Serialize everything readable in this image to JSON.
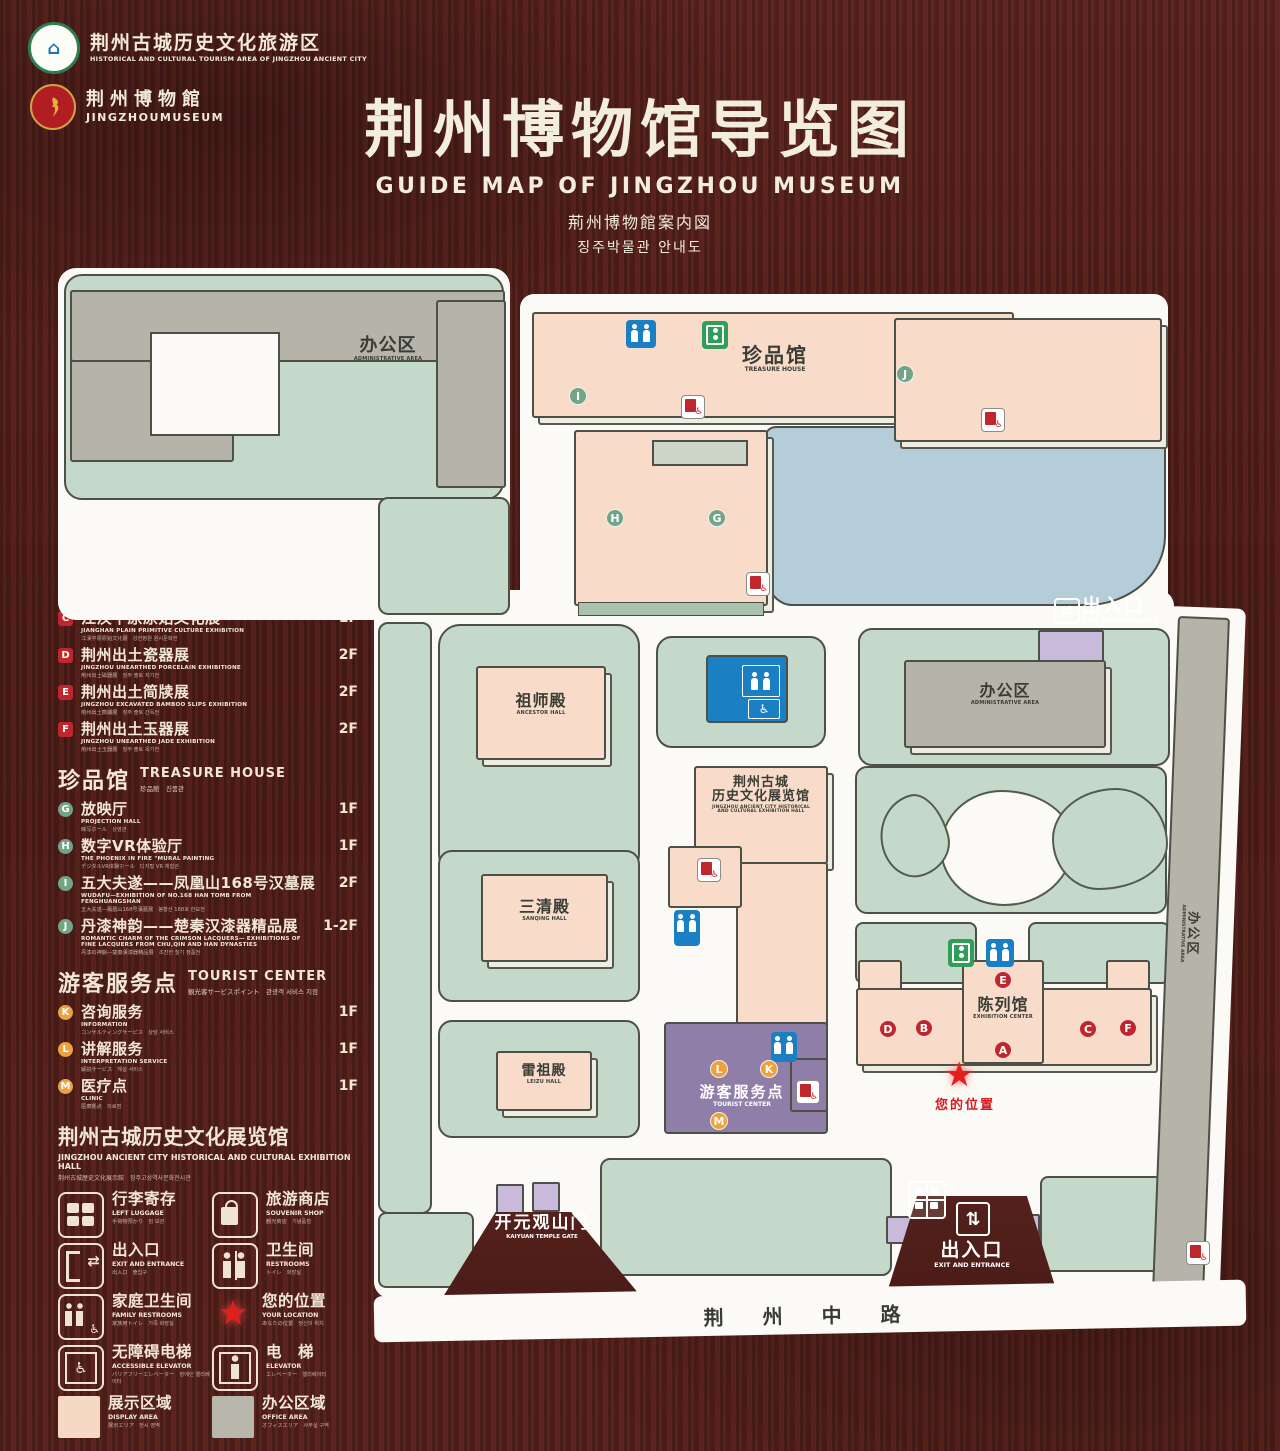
{
  "header": {
    "logo1": {
      "zh": "荆州古城历史文化旅游区",
      "en": "HISTORICAL AND CULTURAL TOURISM AREA OF JINGZHOU ANCIENT CITY"
    },
    "logo2": {
      "zh": "荆州博物館",
      "en": "JINGZHOUMUSEUM"
    },
    "title": "荆州博物馆导览图",
    "subtitle_en": "GUIDE MAP OF JINGZHOU MUSEUM",
    "subtitle_ja": "荊州博物館案内図",
    "subtitle_ko": "징주박물관 안내도"
  },
  "legend": {
    "exhibition": {
      "title_zh": "陈列馆",
      "title_en": "EXHIBITION CENTER",
      "title_sub": "陳列館　진열관",
      "items": [
        {
          "letter": "A",
          "zh": "《火中的凤凰》壁画",
          "en": "THE PHOENIX IN FIRE \"MURAL PAINTING",
          "sub": "「火中の鳳凰」壁画　《불 속의 봉황》 벽화",
          "floor": "1F"
        },
        {
          "letter": "B",
          "zh": "荆州出土铜器展",
          "en": "JINGZHOU UNEARTHED BRONZE WARE EXHIBITION",
          "sub": "荊州出土銅器展　징주 출토 동기 전시",
          "floor": "1F"
        },
        {
          "letter": "C",
          "zh": "江汉平原原始文化展",
          "en": "JIANGHAN PLAIN PRIMITIVE CULTURE EXHIBITION",
          "sub": "江漢平原原始文化展　강한평원 원시문화전",
          "floor": "1F"
        },
        {
          "letter": "D",
          "zh": "荆州出土瓷器展",
          "en": "JINGZHOU UNEARTHED PORCELAIN EXHIBITIONE",
          "sub": "荊州出土磁器展　징주 출토 자기전",
          "floor": "2F"
        },
        {
          "letter": "E",
          "zh": "荆州出土简牍展",
          "en": "JINGZHOU EXCAVATED BAMBOO SLIPS EXHIBITION",
          "sub": "荊州出土簡牘展　징주 출토 간독전",
          "floor": "2F"
        },
        {
          "letter": "F",
          "zh": "荆州出土玉器展",
          "en": "JINGZHOU UNEARTHED JADE EXHIBITION",
          "sub": "荊州出土玉器展　징주 출토 옥기전",
          "floor": "2F"
        }
      ]
    },
    "treasure": {
      "title_zh": "珍品馆",
      "title_en": "TREASURE HOUSE",
      "title_sub": "珍品館　진품관",
      "items": [
        {
          "letter": "G",
          "zh": "放映厅",
          "en": "PROJECTION HALL",
          "sub": "映写ホール　상영관",
          "floor": "1F"
        },
        {
          "letter": "H",
          "zh": "数字VR体验厅",
          "en": "THE PHOENIX IN FIRE \"MURAL PAINTING",
          "sub": "デジタルVR体験ホール　디지털 VR 체험관",
          "floor": "1F"
        },
        {
          "letter": "I",
          "zh": "五大夫遂——凤凰山168号汉墓展",
          "en": "WUDAFU—EXHIBITION OF NO.168 HAN TOMB FROM FENGHUANGSHAN",
          "sub": "五大夫遂—鳳凰山168号漢墓展　봉황산 168호 한묘전",
          "floor": "2F"
        },
        {
          "letter": "J",
          "zh": "丹漆神韵——楚秦汉漆器精品展",
          "en": "ROMANTIC CHARM OF THE CRIMSON LACQUERS— EXHIBITIONS OF FINE LACQUERS FROM CHU,QIN AND HAN DYNASTIES",
          "sub": "丹漆の神韻—楚秦漢漆器精品展　초진한 칠기 정품전",
          "floor": "1-2F"
        }
      ]
    },
    "tourist": {
      "title_zh": "游客服务点",
      "title_en": "TOURIST CENTER",
      "title_sub": "観光客サービスポイント　관광객 서비스 지점",
      "items": [
        {
          "letter": "K",
          "zh": "咨询服务",
          "en": "INFORMATION",
          "sub": "コンサルティングサービス　상담 서비스",
          "floor": "1F"
        },
        {
          "letter": "L",
          "zh": "讲解服务",
          "en": "INTERPRETATION SERVICE",
          "sub": "解説サービス　해설 서비스",
          "floor": "1F"
        },
        {
          "letter": "M",
          "zh": "医疗点",
          "en": "CLINIC",
          "sub": "医療拠点　의료점",
          "floor": "1F"
        }
      ]
    },
    "hall_note": {
      "zh": "荆州古城历史文化展览馆",
      "en": "JINGZHOU ANCIENT CITY HISTORICAL AND CULTURAL EXHIBITION HALL",
      "sub": "荆州古城歴史文化展示館　징주고성역사문화전시관"
    },
    "symbols": [
      {
        "icon": "left-luggage",
        "zh": "行李寄存",
        "en": "LEFT LUGGAGE",
        "sub": "手荷物預かり　짐 보관"
      },
      {
        "icon": "souvenir-shop",
        "zh": "旅游商店",
        "en": "SOUVENIR SHOP",
        "sub": "観光商店　기념품점"
      },
      {
        "icon": "exit-entrance",
        "zh": "出入口",
        "en": "EXIT AND ENTRANCE",
        "sub": "出入口　출입구"
      },
      {
        "icon": "restrooms",
        "zh": "卫生间",
        "en": "RESTROOMS",
        "sub": "トイレ　화장실"
      },
      {
        "icon": "family-restrooms",
        "zh": "家庭卫生间",
        "en": "FAMILY RESTROOMS",
        "sub": "家族用トイレ　가족 화장실"
      },
      {
        "icon": "your-location",
        "zh": "您的位置",
        "en": "YOUR LOCATION",
        "sub": "あなたの位置　당신의 위치"
      },
      {
        "icon": "accessible-elevator",
        "zh": "无障碍电梯",
        "en": "ACCESSIBLE ELEVATOR",
        "sub": "バリアフリーエレベーター　장애인 엘리베이터"
      },
      {
        "icon": "elevator",
        "zh": "电　梯",
        "en": "ELEVATOR",
        "sub": "エレベーター　엘리베이터"
      },
      {
        "icon": "display-area",
        "zh": "展示区域",
        "en": "DISPLAY AREA",
        "sub": "展示エリア　전시 영역"
      },
      {
        "icon": "office-area",
        "zh": "办公区域",
        "en": "OFFICE AREA",
        "sub": "オフィスエリア　사무실 구역"
      }
    ]
  },
  "map": {
    "labels": {
      "admin_top": {
        "zh": "办公区",
        "en": "ADMINISTRATIVE AREA"
      },
      "treasure": {
        "zh": "珍品馆",
        "en": "TREASURE HOUSE"
      },
      "ancestor": {
        "zh": "祖师殿",
        "en": "ANCESTOR HALL"
      },
      "sanqing": {
        "zh": "三清殿",
        "en": "SANQING HALL"
      },
      "leizu": {
        "zh": "雷祖殿",
        "en": "LEIZU HALL"
      },
      "exh_hall": {
        "zh1": "荆州古城",
        "zh2": "历史文化展览馆",
        "en1": "JINGZHOU ANCIENT CITY HISTORICAL",
        "en2": "AND CULTURAL EXHIBITION HALL"
      },
      "admin_right": {
        "zh": "办公区",
        "en": "ADMINISTRATIVE AREA"
      },
      "admin_strip": {
        "zh": "办公区",
        "en": "ADMINISTRATIVE AREA"
      },
      "exh_center": {
        "zh": "陈列馆",
        "en": "EXHIBITION CENTER"
      },
      "tourist": {
        "zh": "游客服务点",
        "en": "TOURIST CENTER"
      },
      "exit_top": {
        "zh": "出入口",
        "en": "EXIT AND ENTRANCE"
      },
      "exit_bottom": {
        "zh": "出入口",
        "en": "EXIT AND ENTRANCE"
      },
      "gate": {
        "zh": "开元观山门",
        "en": "KAIYUAN TEMPLE GATE"
      },
      "road": "荆 州 中 路",
      "your_location": "您的位置"
    },
    "markers_green": [
      {
        "l": "I",
        "x": 578,
        "y": 396
      },
      {
        "l": "J",
        "x": 905,
        "y": 374
      },
      {
        "l": "H",
        "x": 615,
        "y": 518
      },
      {
        "l": "G",
        "x": 717,
        "y": 518
      }
    ],
    "markers_red": [
      {
        "l": "D",
        "x": 888,
        "y": 1029
      },
      {
        "l": "B",
        "x": 924,
        "y": 1028
      },
      {
        "l": "E",
        "x": 1003,
        "y": 980
      },
      {
        "l": "A",
        "x": 1003,
        "y": 1050
      },
      {
        "l": "C",
        "x": 1088,
        "y": 1029
      },
      {
        "l": "F",
        "x": 1128,
        "y": 1028
      }
    ],
    "markers_orange": [
      {
        "l": "L",
        "x": 719,
        "y": 1069
      },
      {
        "l": "K",
        "x": 769,
        "y": 1069
      },
      {
        "l": "M",
        "x": 719,
        "y": 1121
      }
    ]
  },
  "colors": {
    "display_area": "#f8dcc9",
    "office_area": "#b6b3a9",
    "lawn": "#c5d9cb",
    "pond": "#b4cdd9",
    "tourist_purple": "#8f7fa8",
    "entrance_lavender": "#c9badb",
    "toilet_blue": "#1b7fc3",
    "elevator_green": "#2f9e58",
    "marker_red": "#c0272d",
    "marker_green": "#74a487",
    "marker_orange": "#eca23e",
    "location_red": "#e01f1f",
    "wood": "#51201b"
  }
}
